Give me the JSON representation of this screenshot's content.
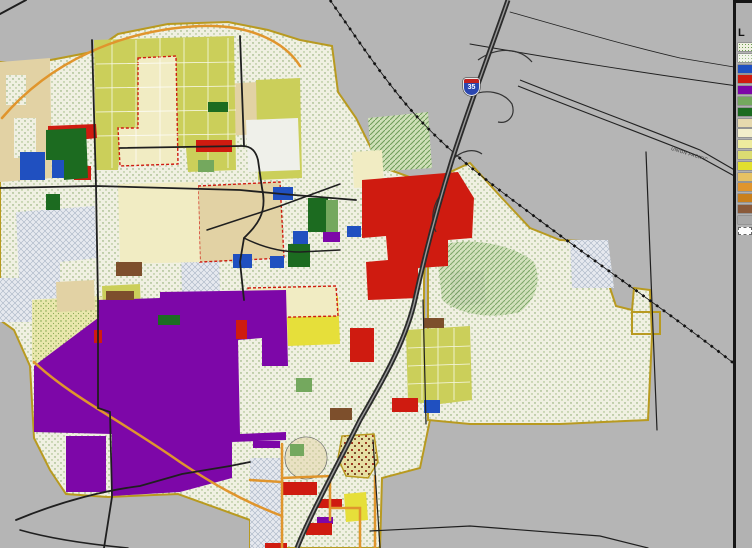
{
  "canvas": {
    "width": 752,
    "height": 548
  },
  "map": {
    "shield": {
      "system": "Interstate",
      "route": "35"
    },
    "railroad_label": "UNION PACIFIC"
  },
  "legend": {
    "title_visible": "L",
    "items": [
      {
        "swatch": "pattern-speckle-green"
      },
      {
        "swatch": "pattern-speckle-light"
      },
      {
        "swatch": "#2050c0"
      },
      {
        "swatch": "#cf1b10"
      },
      {
        "swatch": "#7d07a8"
      },
      {
        "swatch": "#74a85e"
      },
      {
        "swatch": "#1c6b20"
      },
      {
        "swatch": "#e6d9ae"
      },
      {
        "swatch": "#f2eecb"
      },
      {
        "swatch": "#eeeb9e"
      },
      {
        "swatch": "#dcdc72"
      },
      {
        "swatch": "#e2df2e"
      },
      {
        "swatch": "#e6c264"
      },
      {
        "swatch": "#e0952d"
      },
      {
        "swatch": "#c9801d"
      },
      {
        "swatch": "#8a5a3a"
      },
      {
        "swatch": "#a8a8a8"
      },
      {
        "swatch": "pattern-dashed-outline"
      }
    ]
  },
  "palette": {
    "bg": "#b5b5b5",
    "speckle_base": "#f0f0e2",
    "speckle_dot": "#7da05e",
    "yellow_green": "#cbcf5a",
    "pale_yellow": "#f1ecc3",
    "bright_yellow": "#e6df3a",
    "tan": "#e2d2a4",
    "red": "#cf1b10",
    "purple": "#7d07a8",
    "blue": "#2050c0",
    "dark_green": "#1c6b20",
    "med_green": "#74a85e",
    "brown": "#7d4f2c",
    "amber": "#c9801d",
    "orange_road": "#e0952d",
    "olive_boundary": "#b89a20",
    "gray_zone": "#9c9c9c",
    "road": "#1f1f1f",
    "highway": "#2b2b2b",
    "shield_blue": "#2a46b0",
    "shield_red": "#c02020"
  }
}
